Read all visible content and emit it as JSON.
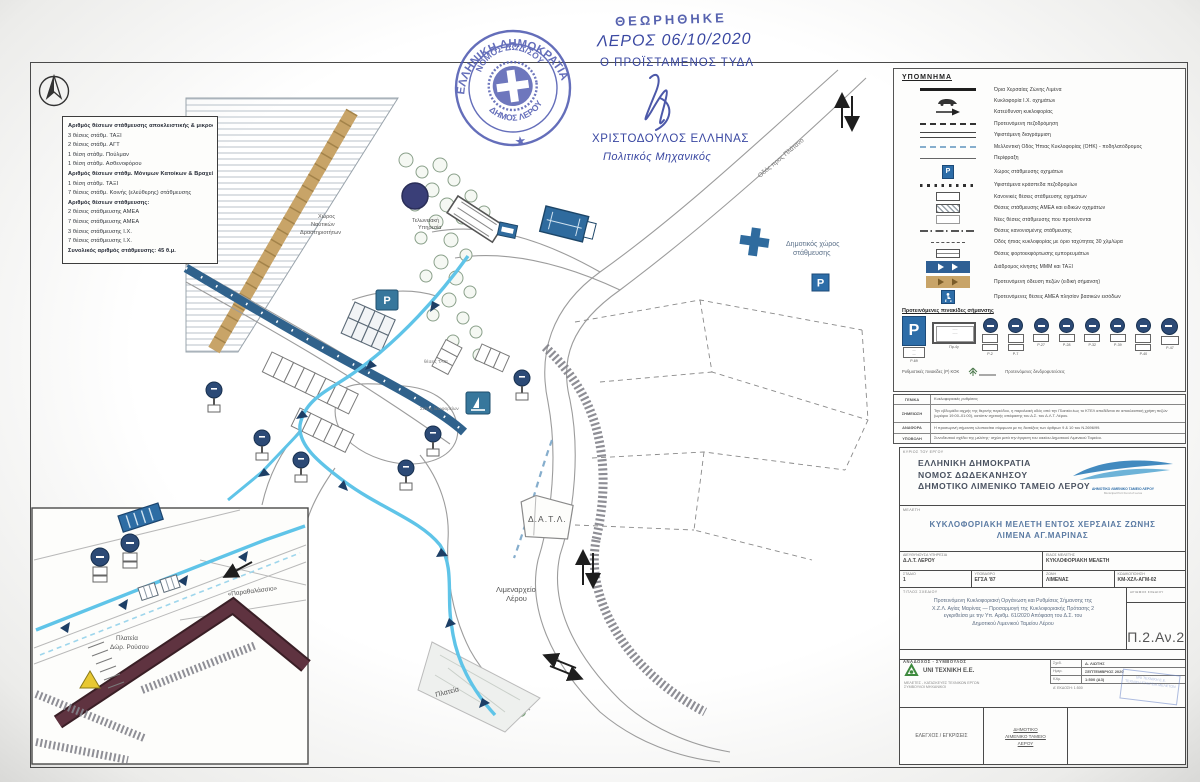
{
  "stamp": {
    "outer": "ΕΛΛΗΝΙΚΗ ΔΗΜΟΚΡΑΤΙΑ",
    "inner_top": "ΝΟΜΟΣ ΔΩΔ/ΣΟΥ",
    "inner_bottom": "ΔΗΜΟΣ ΛΕΡΟΥ",
    "star": "★"
  },
  "approval": {
    "reviewed": "ΘΕΩΡΗΘΗΚΕ",
    "place_date": "ΛΕΡΟΣ 06/10/2020",
    "role": "Ο ΠΡΟΪΣΤΑΜΕΝΟΣ ΤΥΔΛ",
    "name": "ΧΡΙΣΤΟΔΟΥΛΟΣ ΕΛΛΗΝΑΣ",
    "profession": "Πολιτικός Μηχανικός"
  },
  "parking_box": {
    "lines": [
      "Αριθμός θέσεων στάθμευσης αποκλειστικής & μικροστάθμευσης:",
      "3 θέσεις στάθμ. ΤΑΞΙ",
      "2 θέσεις στάθμ. ΑΓΤ",
      "1 θέση στάθμ. Πούλμαν",
      "1 θέση στάθμ. Ασθενοφόρου",
      "Αριθμός θέσεων στάθμ. Μόνιμων Κατοίκων & Βραχείας (ζώνη Ω2):",
      "1 θέση στάθμ. ΤΑΞΙ",
      "7 θέσεις στάθμ. Κοινής (ελεύθερης) στάθμευσης",
      "Αριθμός θέσεων στάθμευσης:",
      "2 θέσεις στάθμευσης ΑΜΕΑ",
      "7 θέσεις στάθμευσης ΑΜΕΑ",
      "3 θέσεις στάθμευσης Ι.Χ.",
      "7 θέσεις στάθμευσης Ι.Χ.",
      "Συνολικός αριθμός στάθμευσης: 45 θ.μ."
    ]
  },
  "map": {
    "labels": {
      "datl": "Δ.Α.Τ.Λ.",
      "port1": "Λιμεναρχείο",
      "port2": "Λέρου",
      "plateia": "Πλατεία",
      "mun1": "Δημοτικός χώρος",
      "mun2": "στάθμευσης",
      "naut1": "Χώρος",
      "naut2": "Ναυτικών",
      "naut3": "Δραστηριοτήτων",
      "cust1": "Τελωνειακή",
      "cust2": "Υπηρεσία",
      "road": "Οδός προς Πλάτανο",
      "taxi": "θέσεις ΤΑΞΙ",
      "bus": "Στάση λεωφορείων",
      "p_glyph": "P"
    },
    "inset": {
      "quote": "«Παραθαλάσσιο»",
      "pl1": "Πλατεία",
      "pl2": "Δώρ. Ρούσου"
    }
  },
  "legend": {
    "title": "ΥΠΟΜΝΗΜΑ",
    "rows": [
      {
        "label": "Όρια Χερσαίας Ζώνης Λιμένα"
      },
      {
        "label": "Κυκλοφορία Ι.Χ. οχημάτων"
      },
      {
        "label": "Κατεύθυνση κυκλοφορίας"
      },
      {
        "label": "Προτεινόμενη πεζοδρόμηση"
      },
      {
        "label": "Υφιστάμενη διαγράμμιση"
      },
      {
        "label": "Μελλοντική Οδός Ήπιας Κυκλοφορίας (ΟΗΚ) - ποδηλατόδρομος"
      },
      {
        "label": "Περίφραξη"
      },
      {
        "label": "Χώρος στάθμευσης οχημάτων"
      },
      {
        "label": "Υφιστάμενα κράσπεδα πεζοδρομίων"
      },
      {
        "label": "Κανονικές θέσεις στάθμευσης οχημάτων"
      },
      {
        "label": "Θέσεις στάθμευσης ΑΜΕΑ και ειδικών οχημάτων"
      },
      {
        "label": "Νέες θέσεις στάθμευσης που προτείνονται"
      },
      {
        "label": "Θέσεις κανονισμένης στάθμευσης"
      },
      {
        "label": "Οδός ήπιας κυκλοφορίας με όριο ταχύτητας 30 χλμ/ώρα"
      },
      {
        "label": "Θέσεις φορτοεκφόρτωσης εμπορευμάτων"
      },
      {
        "label": "Διάδρομος κίνησης ΜΜΜ και ΤΑΞΙ"
      },
      {
        "label": "Προτεινόμενη όδευση πεζών (ειδική σήμανση)"
      },
      {
        "label": "Προτεινόμενες θέσεις ΑΜΕΑ πλησίον βασικών εισόδων"
      }
    ],
    "signs_header": "Προτεινόμενες πινακίδες σήμανσης",
    "p_caption": "Ρ-69",
    "rect_caption": "Πρ-4γ",
    "sign_captions": [
      "Ρ-2",
      "Ρ-7",
      "Ρ-27",
      "Ρ-28",
      "Ρ-32",
      "Ρ-39",
      "Ρ-40",
      "Ρ-47"
    ],
    "signs_note": "Ρυθμιστικές πινακίδες (Ρ) ΚΟΚ",
    "tree_note": "Προτεινόμενες δενδροφυτεύσεις"
  },
  "notes": {
    "rows": [
      {
        "k": "ΓΕΝΙΚΑ",
        "v": "Κυκλοφοριακές ρυθμίσεις"
      },
      {
        "k": "ΣΗΜΕΙΩΣΗ",
        "v": "Την εβδομάδα αιχμής της θερινής περιόδου, η παραλιακή οδός από την Πλατεία έως το ΚΤΕΛ αποδίδεται σε αποκλειστική χρήση πεζών (ωράριο 19:00–01:00), κατόπιν σχετικής απόφασης του Δ.Σ. του Δ.Λ.Τ. Λέρου."
      },
      {
        "k": "ΑΝΑΦΟΡΑ",
        "v": "Η προσωρινή σήμανση υλοποιείται σύμφωνα με τις διατάξεις των άρθρων 9 & 10 του Ν.2696/99."
      },
      {
        "k": "ΥΠΟΒΟΛΗ",
        "v": "Συνοδευτικό σχέδιο της μελέτης· ισχύει μετά την έγκριση του οικείου Δημοτικού Λιμενικού Ταμείου."
      }
    ]
  },
  "titleblock": {
    "owner_label": "ΚΥΡΙΟΣ ΤΟΥ ΕΡΓΟΥ",
    "org1": "ΕΛΛΗΝΙΚΗ ΔΗΜΟΚΡΑΤΙΑ",
    "org2": "ΝΟΜΟΣ ΔΩΔΕΚΑΝΗΣΟΥ",
    "org3": "ΔΗΜΟΤΙΚΟ ΛΙΜΕΝΙΚΟ ΤΑΜΕΙΟ ΛΕΡΟΥ",
    "logo_caption1": "ΔΗΜΟΤΙΚΟ ΛΙΜΕΝΙΚΟ ΤΑΜΕΙΟ ΛΕΡΟΥ",
    "logo_caption2": "Municipal Port Fund of Leros",
    "study_label": "ΜΕΛΕΤΗ",
    "title1": "ΚΥΚΛΟΦΟΡΙΑΚΗ ΜΕΛΕΤΗ ΕΝΤΟΣ ΧΕΡΣΑΙΑΣ ΖΩΝΗΣ",
    "title2": "ΛΙΜΕΝΑ ΑΓ.ΜΑΡΙΝΑΣ",
    "f1l": "ΔΙΕΥΘΥΝΟΥΣΑ ΥΠΗΡΕΣΙΑ",
    "f1v": "Δ.Λ.Τ. ΛΕΡΟΥ",
    "f2l": "ΕΙΔΟΣ ΜΕΛΕΤΗΣ",
    "f2v": "ΚΥΚΛΟΦΟΡΙΑΚΗ ΜΕΛΕΤΗ",
    "f3l": "ΣΤΑΔΙΟ",
    "f3v": "1",
    "f4l": "ΥΠΟΒΑΘΡΟ",
    "f4v": "ΕΓΣΑ '87",
    "f5l": "ΖΩΝΗ",
    "f5v": "ΛΙΜΕΝΑΣ",
    "f6l": "ΚΩΔΙΚΟΠΟΙΗΣΗ",
    "f6v": "ΚΜ-ΧΖΛ-ΑΓΜ-02",
    "sheet_label": "ΤΙΤΛΟΣ ΣΧΕΔΙΟΥ",
    "sheet1": "Προτεινόμενη Κυκλοφοριακή Οργάνωση και Ρυθμίσεις Σήμανσης της",
    "sheet2": "Χ.Ζ.Λ. Αγίας Μαρίνας — Προσαρμογή της Κυκλοφοριακής Πρότασης 2",
    "sheet3": "εγκριθείσα με την Υπ. Αριθμ. 61/2020 Απόφαση του Δ.Σ. του",
    "sheet4": "Δημοτικού Λιμενικού Ταμείου Λέρου",
    "num_label": "ΑΡΙΘΜΟΣ ΣΧΕΔΙΟΥ",
    "num": "Π.2.Αν.2",
    "contractor_label": "ΑΝΑΔΟΧΟΣ - ΣΥΜΒΟΥΛΟΣ",
    "company": "UNI ΤΕΧΝΙΚΗ Ε.Ε.",
    "company_sub1": "ΜΕΛΕΤΕΣ - ΚΑΤΑΣΚΕΥΕΣ ΤΕΧΝΙΚΩΝ ΕΡΓΩΝ",
    "company_sub2": "ΣΥΜΒΟΥΛΟΙ ΜΗΧΑΝΙΚΟΙ",
    "t1l": "Σχεδ.",
    "t1v": "Δ. ΛΙΩΤΗΣ",
    "t2l": "Ημερ.",
    "t2v": "ΣΕΠΤΕΜΒΡΙΟΣ 2020",
    "t3l": "Κλίμ.",
    "t3v": "1:500 (Α3)",
    "edition": "Α' ΕΚΔΟΣΗ: 1:500",
    "stamp_line1": "UNI ΤΕΧΝΙΚΗ Ε.Ε.",
    "stamp_line2": "ΤΕΧΝΙΚΗ ΕΤΑΙΡΕΙΑ ΜΕΛΕΤΩΝ",
    "check_label": "ΕΛΕΓΧΟΣ / ΕΓΚΡΙΣΕΙΣ",
    "appr1": "ΔΗΜΟΤΙΚΟ",
    "appr2": "ΛΙΜΕΝΙΚΟ ΤΑΜΕΙΟ",
    "appr3": "ΛΕΡΟΥ"
  }
}
